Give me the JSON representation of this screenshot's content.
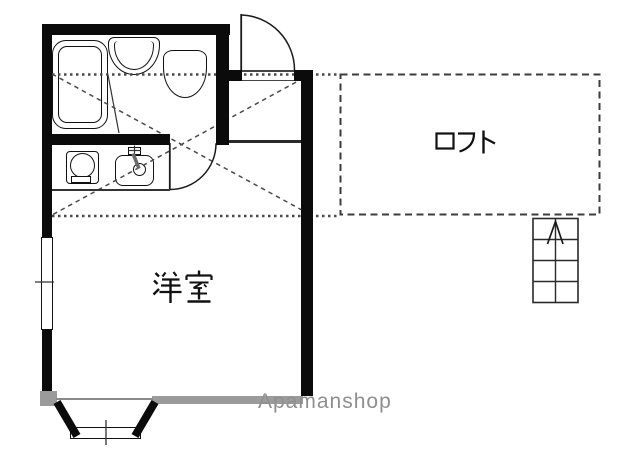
{
  "plan": {
    "type": "apartment-floorplan",
    "rooms": {
      "western_room": {
        "label": "洋室"
      },
      "loft": {
        "label": "ロフト"
      }
    },
    "stairs": {
      "arrow_direction": "up",
      "rows": 4
    },
    "watermark": {
      "text": "Apamanshop",
      "color": "#8f8f8f"
    },
    "fixtures": [
      "bathtub",
      "wash-basin",
      "toilet",
      "washing-machine",
      "kitchen-sink",
      "faucet",
      "entrance-door",
      "bathroom-door",
      "left-window",
      "bay-window",
      "loft-ladder-stairs"
    ],
    "colors": {
      "wall": "#0b0b0b",
      "linework": "#333333",
      "dashed_loft_outline": "#3c3c3c",
      "gray_accent": "#9b9b9b",
      "background": "#ffffff"
    }
  }
}
